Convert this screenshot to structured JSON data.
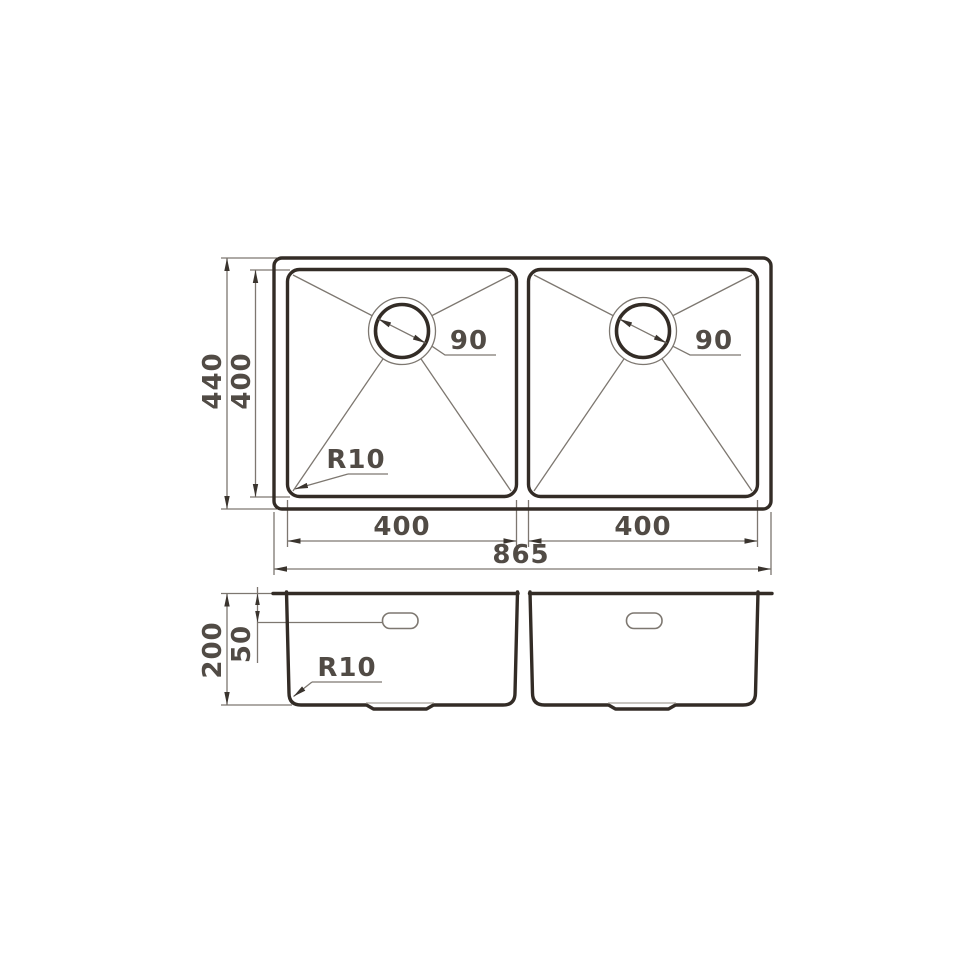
{
  "title": "Double bowl undermount sink technical drawing",
  "colors": {
    "outline": "#332c26",
    "thin": "#7d7770",
    "text": "#514b45",
    "arrow": "#3a342e",
    "light": "#a8a29a",
    "bg": "#ffffff"
  },
  "top_view": {
    "overall_depth": "440",
    "bowl_depth": "400",
    "bowl_left_width": "400",
    "bowl_right_width": "400",
    "overall_width": "865",
    "drain_left_diameter": "90",
    "drain_right_diameter": "90",
    "corner_radius": "R10"
  },
  "side_view": {
    "overall_height": "200",
    "overflow_offset": "50",
    "corner_radius": "R10"
  }
}
